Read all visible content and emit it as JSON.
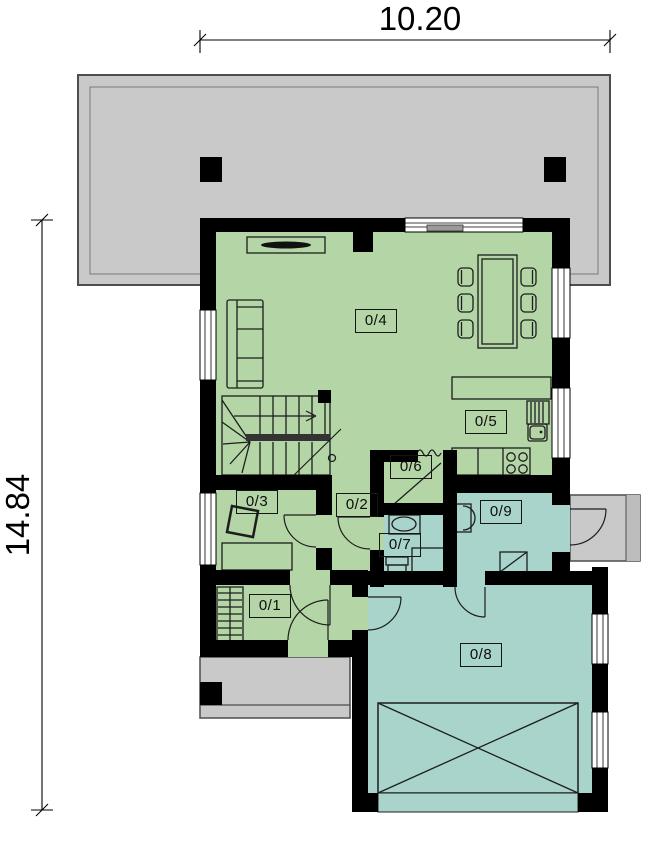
{
  "drawing": {
    "kind": "house ground floor plan",
    "dimensions": {
      "width": "10.20",
      "height": "14.84"
    }
  },
  "rooms": [
    {
      "label": "0/1",
      "color": "#b4d6a6"
    },
    {
      "label": "0/2",
      "color": "#b4d6a6"
    },
    {
      "label": "0/3",
      "color": "#b4d6a6"
    },
    {
      "label": "0/4",
      "color": "#b4d6a6"
    },
    {
      "label": "0/5",
      "color": "#b4d6a6"
    },
    {
      "label": "0/6",
      "color": "#b4d6a6"
    },
    {
      "label": "0/7",
      "color": "#a9d4cb"
    },
    {
      "label": "0/8",
      "color": "#a9d4cb"
    },
    {
      "label": "0/9",
      "color": "#a9d4cb"
    }
  ],
  "colors": {
    "wall": "#000000",
    "green_zone": "#b4d6a6",
    "teal_zone": "#a9d4cb",
    "concrete": "#c9c9c9",
    "linework": "#1d1d1d",
    "background": "#ffffff"
  },
  "furniture_symbols": [
    "tv-cabinet",
    "sofa",
    "dining-table",
    "dining-chairs",
    "staircase",
    "kitchen-island",
    "dish-rack",
    "sink",
    "cooktop",
    "desk",
    "office-chair",
    "wardrobe",
    "washbasin",
    "toilet",
    "shower",
    "washing-machine",
    "boiler",
    "car-space",
    "door-swings",
    "terrace",
    "porch",
    "entry-step"
  ]
}
